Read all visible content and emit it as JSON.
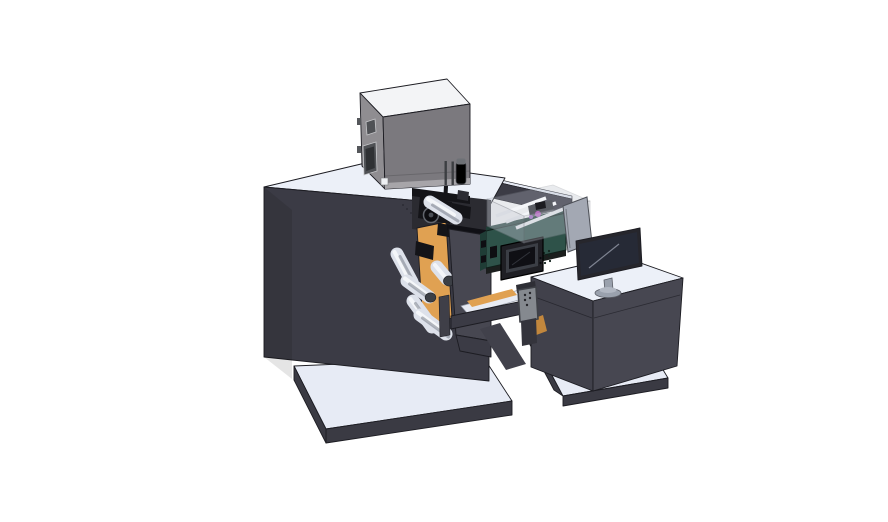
{
  "colors": {
    "bg": "#ffffff",
    "edge": "#1c1c22",
    "machineFront": "#3b3b45",
    "machineSide": "#474751",
    "deskLeft": "#41414b",
    "surfaceTop": "#ecf0f8",
    "baseTop": "#e7ebf5",
    "baseSide": "#3a3a43",
    "hopperFront": "#7b797e",
    "hopperSide": "#8f8d91",
    "hopperTop": "#f3f4f6",
    "windowDark": "#4f5155",
    "rollerBody": "#dde1ea",
    "rollerHi": "#f6f8fb",
    "capDark": "#3c3f45",
    "orange": "#e0a152",
    "orangeDark": "#c2873d",
    "greenFront": "#2e5249",
    "greenSide": "#1f3d36",
    "hmiBezel": "#1f1f24",
    "hmiScreen": "#0f0f14",
    "clearWall": "#b9bec9",
    "railWhite": "#f4f6f9",
    "magenta": "#c06cc9",
    "partition": "#a3a8b3",
    "monitorBezel": "#26262c",
    "monitorScreen": "#262a36",
    "standGray": "#9aa1ad",
    "pendant": "#85898f",
    "blackPart": "#141418",
    "recess": "#2b2b31"
  }
}
